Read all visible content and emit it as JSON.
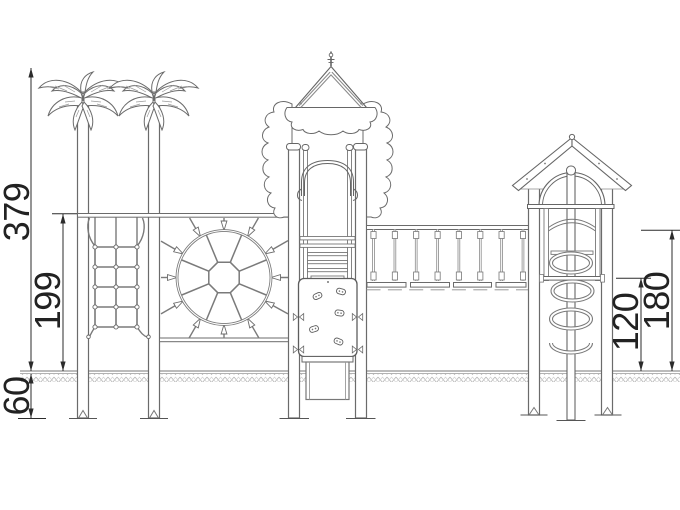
{
  "dimensions": {
    "total_height": "379",
    "platform_rail_height": "199",
    "foundation_depth": "60",
    "bridge_deck_height": "120",
    "tower_rail_height": "180"
  },
  "colors": {
    "background": "#ffffff",
    "structure_line": "#6b6b6b",
    "rope_line": "#7a7a7a",
    "dimension_line": "#2b2b2b",
    "dimension_text": "#222222"
  }
}
